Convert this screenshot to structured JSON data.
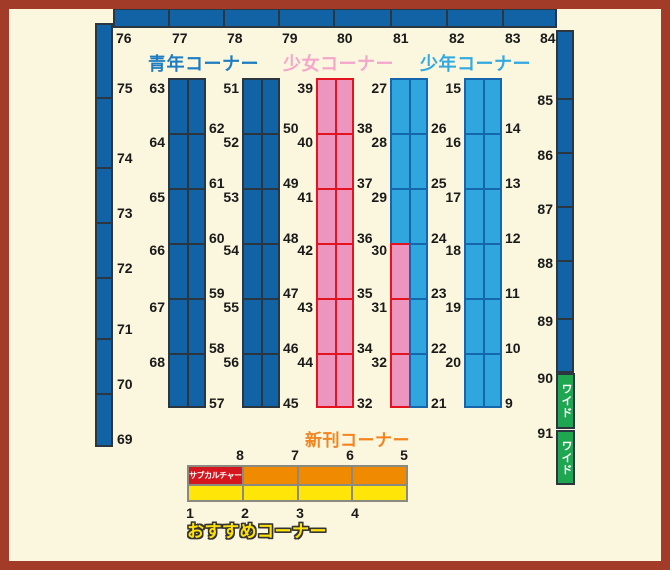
{
  "page": {
    "background": "#FBF7DE",
    "border_color": "#A23B28"
  },
  "colors": {
    "seinen_fill": "#1262A6",
    "seinen_border": "#2A3740",
    "shoujo_fill": "#EC95BE",
    "shoujo_border": "#E3131F",
    "shounen_fill": "#2FA7DE",
    "shounen_border": "#1566AC",
    "wall_fill": "#1262A6",
    "wall_border": "#2A3740",
    "green_fill": "#1EA650",
    "orange_fill": "#F08A00",
    "yellow_fill": "#FFE608",
    "red_fill": "#D5161E",
    "grid_border": "#8A8A80",
    "number_color": "#1A1A1A",
    "title_seinen": "#1E7CC2",
    "title_shoujo": "#F4A6CB",
    "title_shounen": "#33A9E0",
    "title_shinkan": "#F5831F",
    "title_osusume": "#FFE20A"
  },
  "titles": {
    "seinen": "青年コーナー",
    "shoujo": "少女コーナー",
    "shounen": "少年コーナー",
    "shinkan": "新刊コーナー",
    "osusume": "おすすめコーナー"
  },
  "walls": {
    "top_labels": [
      "76",
      "77",
      "78",
      "79",
      "80",
      "81",
      "82",
      "83",
      "84"
    ],
    "left_labels": [
      "75",
      "74",
      "73",
      "72",
      "71",
      "70",
      "69"
    ],
    "right_labels": [
      "85",
      "86",
      "87",
      "88",
      "89",
      "90",
      "91"
    ],
    "wide_segments": [
      "ワイド",
      "ワイド"
    ]
  },
  "shelves": [
    {
      "name": "seinen-shelf-1",
      "left_labels": [
        "63",
        "64",
        "65",
        "66",
        "67",
        "68"
      ],
      "right_labels": [
        "62",
        "61",
        "60",
        "59",
        "58",
        "57"
      ],
      "left_cells": [
        "seinen",
        "seinen",
        "seinen",
        "seinen",
        "seinen",
        "seinen"
      ],
      "right_cells": [
        "seinen",
        "seinen",
        "seinen",
        "seinen",
        "seinen",
        "seinen"
      ]
    },
    {
      "name": "seinen-shelf-2",
      "left_labels": [
        "51",
        "52",
        "53",
        "54",
        "55",
        "56"
      ],
      "right_labels": [
        "50",
        "49",
        "48",
        "47",
        "46",
        "45"
      ],
      "left_cells": [
        "seinen",
        "seinen",
        "seinen",
        "seinen",
        "seinen",
        "seinen"
      ],
      "right_cells": [
        "seinen",
        "seinen",
        "seinen",
        "seinen",
        "seinen",
        "seinen"
      ]
    },
    {
      "name": "shoujo-shelf",
      "left_labels": [
        "39",
        "40",
        "41",
        "42",
        "43",
        "44"
      ],
      "right_labels": [
        "38",
        "37",
        "36",
        "35",
        "34",
        "32"
      ],
      "left_cells": [
        "shoujo",
        "shoujo",
        "shoujo",
        "shoujo",
        "shoujo",
        "shoujo"
      ],
      "right_cells": [
        "shoujo",
        "shoujo",
        "shoujo",
        "shoujo",
        "shoujo",
        "shoujo"
      ]
    },
    {
      "name": "shoujo-shounen-shelf",
      "left_labels": [
        "27",
        "28",
        "29",
        "30",
        "31",
        "32"
      ],
      "right_labels": [
        "26",
        "25",
        "24",
        "23",
        "22",
        "21"
      ],
      "left_cells": [
        "shounen",
        "shounen",
        "shounen",
        "shoujo",
        "shoujo",
        "shoujo"
      ],
      "right_cells": [
        "shounen",
        "shounen",
        "shounen",
        "shounen",
        "shounen",
        "shounen"
      ]
    },
    {
      "name": "shounen-shelf",
      "left_labels": [
        "15",
        "16",
        "17",
        "18",
        "19",
        "20"
      ],
      "right_labels": [
        "14",
        "13",
        "12",
        "11",
        "10",
        "9"
      ],
      "left_cells": [
        "shounen",
        "shounen",
        "shounen",
        "shounen",
        "shounen",
        "shounen"
      ],
      "right_cells": [
        "shounen",
        "shounen",
        "shounen",
        "shounen",
        "shounen",
        "shounen"
      ]
    }
  ],
  "new_releases_shelf": {
    "subculture_label": "サブカルチャー",
    "top_labels": [
      "8",
      "7",
      "6",
      "5"
    ],
    "bottom_labels": [
      "1",
      "2",
      "3",
      "4"
    ],
    "top_cells": [
      "subculture",
      "orange",
      "orange",
      "orange"
    ],
    "bottom_cells": [
      "yellow",
      "yellow",
      "yellow",
      "yellow"
    ]
  }
}
